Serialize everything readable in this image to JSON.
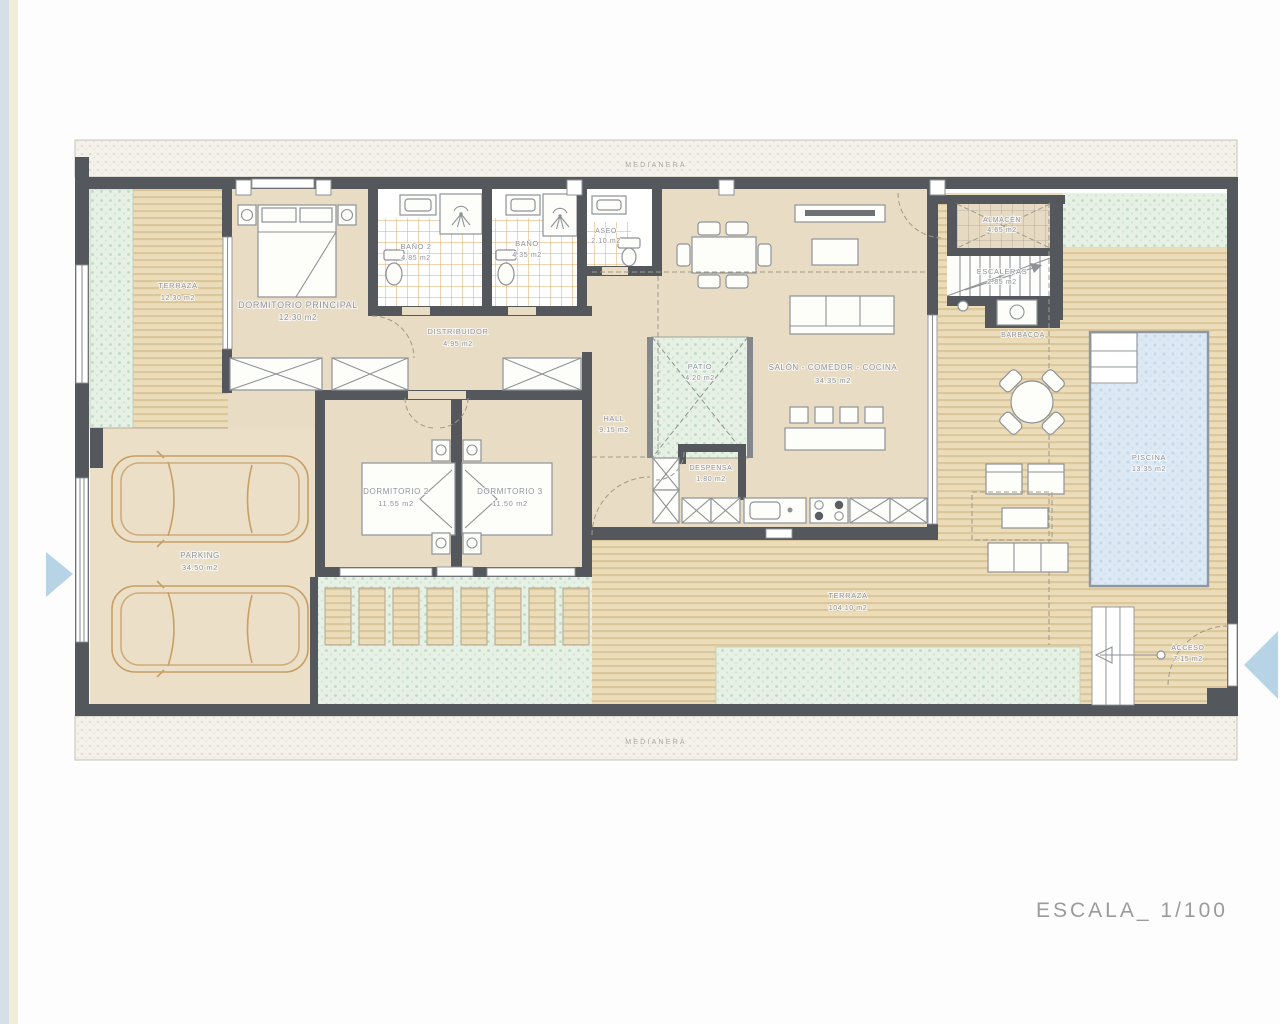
{
  "plan": {
    "scale_label": "ESCALA_ 1/100"
  },
  "boundaries": {
    "top_label": "MEDIANERA",
    "bottom_label": "MEDIANERA"
  },
  "rooms": {
    "terraza": {
      "name": "TERRAZA",
      "area": "12.30 m2"
    },
    "dormitorio_principal": {
      "name": "DORMITORIO PRINCIPAL",
      "area": "12.30 m2"
    },
    "bano2": {
      "name": "BAÑO 2",
      "area": "4.85 m2"
    },
    "bano": {
      "name": "BAÑO",
      "area": "4.35 m2"
    },
    "aseo": {
      "name": "ASEO",
      "area": "2.10 m2"
    },
    "distribuidor": {
      "name": "DISTRIBUIDOR",
      "area": "4.95 m2"
    },
    "hall": {
      "name": "HALL",
      "area": "9.15 m2"
    },
    "patio": {
      "name": "PATIO",
      "area": "4.20 m2"
    },
    "salon": {
      "name": "SALÓN - COMEDOR - COCINA",
      "area": "34.35 m2"
    },
    "dormitorio2": {
      "name": "DORMITORIO 2",
      "area": "11.55 m2"
    },
    "dormitorio3": {
      "name": "DORMITORIO 3",
      "area": "11.50 m2"
    },
    "despensa": {
      "name": "DESPENSA",
      "area": "1.80 m2"
    },
    "parking": {
      "name": "PARKING",
      "area": "34.50 m2"
    },
    "almacen": {
      "name": "ALMACÉN",
      "area": "4.65 m2"
    },
    "escaleras": {
      "name": "ESCALERAS",
      "area": "2.85 m2"
    },
    "barbacoa": {
      "name": "BARBACOA"
    },
    "terraza_main": {
      "name": "TERRAZA",
      "area": "104.10 m2"
    },
    "piscina": {
      "name": "PISCINA",
      "area": "13.35 m2"
    },
    "acceso": {
      "name": "ACCESO",
      "area": "7.15 m2"
    }
  },
  "colors": {
    "wall": "#54585c",
    "floor": "#e9dcc5",
    "deck": "#ebdcba",
    "green": "#e6f0e4",
    "pool": "#dce9f4",
    "nav_arrow": "#b7d3e6"
  }
}
